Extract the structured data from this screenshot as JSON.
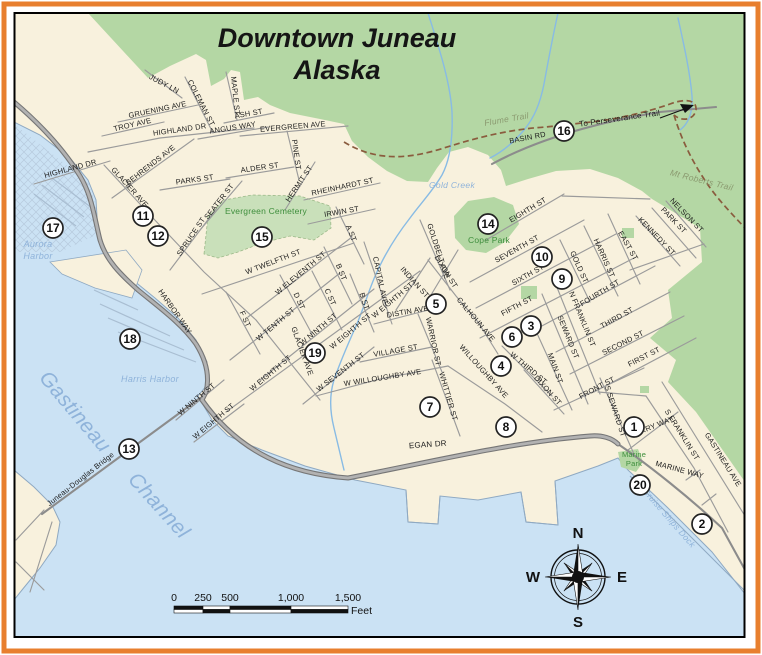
{
  "title": {
    "line1": "Downtown Juneau",
    "line2": "Alaska"
  },
  "colors": {
    "frame_orange": "#e87f2e",
    "map_border": "#000000",
    "land": "#f8f1dd",
    "forest": "#b4d7a4",
    "cemetery": "#c9e0ba",
    "water": "#cbe2f4",
    "shore": "#8fa9c2",
    "dock": "#a9bed2",
    "creek": "#88bbe4",
    "road_thin": "#9b9b9b",
    "road_medium": "#8c8c8c",
    "road_thick_casing": "#767676",
    "road_thick_core": "#b2b2b2",
    "trail": "#8a5c3e",
    "street_text": "#1c1c1c",
    "water_text": "#8fb3da",
    "park_text": "#3e8e3c",
    "trail_text": "#8b9a70",
    "title_text": "#151515"
  },
  "geometry": {
    "map_rect": {
      "x": 14.5,
      "y": 13,
      "w": 730,
      "h": 624
    },
    "orange_rect": {
      "x": 4,
      "y": 4,
      "w": 754,
      "h": 647,
      "sw": 5
    },
    "areas": [
      {
        "name": "forest-area",
        "d": "M88,13 L148,78 L170,66 L196,54 L206,60 L211,86 L224,79 L231,70 L240,72 L244,100 L258,97 L270,105 L290,113 L320,119 L344,124 L352,141 L368,157 L387,171 L407,181 L428,182 L437,168 L449,152 L468,147 L488,155 L501,170 L506,186 L528,179 L556,171 L590,169 L618,178 L642,191 L652,199 L700,228 L702,262 L668,290 L672,318 L650,338 L676,360 L668,382 L696,412 L745,482 L745,13 Z",
        "fill": "forest"
      },
      {
        "name": "evergreen-cemetery-area",
        "d": "M204,254 L208,216 L224,200 L252,195 L300,196 L330,206 L331,228 L314,240 L290,236 L262,243 L238,252 L218,258 Z",
        "fill": "cemetery",
        "stroke": "#9cb989",
        "sw": 0.8,
        "dash": "3,2"
      },
      {
        "name": "water-area",
        "d": "M14,122 L40,135 L70,158 L88,180 L96,200 L98,232 L108,256 L128,276 L155,298 L178,318 L196,340 L207,362 L207,385 L198,396 L212,420 L228,436 L262,450 L305,466 L355,480 L406,490 L408,522 L438,524 L440,496 L478,500 L521,492 L526,522 L558,525 L555,481 L598,466 L618,458 L628,470 L668,508 L712,552 L745,594 L745,637 L14,637 Z",
        "fill": "water"
      },
      {
        "name": "tidal-flat-hatch",
        "d": "M14,124 L88,182 L96,206 L98,234 L60,252 L14,252 Z",
        "fill": "url(#hatch)"
      },
      {
        "name": "shoreline",
        "d": "M14,122 L40,135 L70,158 L88,180 L96,200 L98,232 L108,256 L128,276 L155,298 L178,318 L196,340 L207,362 L207,385 L198,396 L212,420 L228,436 L262,450 L305,466 L355,480 L406,490 L408,522 L438,524 L440,496 L478,500 L521,492 L526,522 L558,525 L555,481 L598,466 L618,458 L628,470 L668,508 L712,552 L745,594",
        "fill": "none",
        "stroke": "shore",
        "sw": 1
      },
      {
        "name": "douglas-island-land",
        "d": "M14,470 L34,487 L52,505 L60,522 L56,545 L40,568 L22,590 L14,600 Z",
        "fill": "land",
        "stroke": "shore",
        "sw": 1
      },
      {
        "name": "harbor-peninsula",
        "d": "M50,262 L126,250 L142,270 L132,298 L95,288 L62,274 Z",
        "fill": "land",
        "stroke": "shore",
        "sw": 0.8
      },
      {
        "name": "cope-park-area",
        "d": "M454,216 L468,201 L494,197 L513,205 L519,224 L505,242 L486,253 L466,250 L455,238 Z",
        "fill": "forest"
      },
      {
        "name": "marine-park-area",
        "d": "M618,452 L638,449 L643,462 L636,472 L621,467 Z",
        "fill": "forest"
      },
      {
        "name": "small-park-1",
        "d": "M521,286 L537,286 L537,299 L521,299 Z",
        "fill": "forest"
      },
      {
        "name": "small-park-2",
        "d": "M622,228 L634,228 L634,238 L622,238 Z",
        "fill": "forest"
      },
      {
        "name": "small-park-3",
        "d": "M640,386 L649,386 L649,393 L640,393 Z",
        "fill": "forest"
      }
    ],
    "docks": [
      "M34,194 L76,226",
      "M42,185 L84,217",
      "M52,178 L92,208",
      "M100,304 L170,336",
      "M108,318 L184,350",
      "M118,332 L196,362",
      "M94,290 L138,310"
    ],
    "piers": [
      "M406,490 L408,522 L438,524 L440,496",
      "M521,492 L526,522 L558,525 L555,481",
      "M630,476 L744,590"
    ],
    "creeks": [
      "M428,13 C438,45 450,80 452,112 C453,140 450,160 442,175 C432,192 420,204 410,218 C396,236 384,256 376,274 C368,292 364,308 356,326 C348,344 340,362 334,380 C329,396 330,412 334,428 L344,470",
      "M558,13 C552,40 548,62 544,84 C540,104 534,118 524,130 C514,142 502,152 490,158",
      "M678,18 C684,45 690,72 692,96 C693,114 688,124 680,130"
    ],
    "roads_thin": [
      "M145,70 L182,98",
      "M185,77 L213,133",
      "M226,72 L237,120",
      "M224,123 L274,113",
      "M118,122 L198,105",
      "M102,136 L164,122",
      "M88,152 L160,138 L254,128",
      "M198,139 L268,127",
      "M240,136 L348,126",
      "M287,131 L299,180",
      "M226,178 L294,167",
      "M285,210 L315,162",
      "M304,200 L380,183",
      "M308,224 L375,209",
      "M112,198 L194,139",
      "M34,184 L110,161",
      "M104,165 L152,217 L204,272 L256,320",
      "M160,190 L230,179",
      "M200,230 L242,181",
      "M170,270 L216,209",
      "M202,294 L354,243",
      "M248,317 L352,237",
      "M230,360 L340,273",
      "M260,380 L374,289",
      "M226,412 L420,271",
      "M303,404 L374,347",
      "M336,207 L364,264",
      "M324,247 L352,304",
      "M312,271 L342,330",
      "M280,275 L312,334",
      "M226,292 L260,354",
      "M256,320 L320,400",
      "M364,242 L392,324",
      "M350,274 L374,332",
      "M396,310 L430,258",
      "M420,220 L450,290",
      "M428,300 L458,250",
      "M374,324 L444,306",
      "M360,362 L432,347",
      "M418,314 L442,372",
      "M432,360 L460,436",
      "M316,396 L380,379 L448,366",
      "M448,366 L505,404 L542,432",
      "M176,420 L224,380",
      "M194,442 L244,404",
      "M486,240 L564,194",
      "M562,196 L650,199",
      "M470,282 L584,220",
      "M476,308 L616,234",
      "M480,338 L634,258",
      "M538,328 L655,266",
      "M556,352 L670,292",
      "M570,374 L684,316",
      "M594,392 L696,338",
      "M554,410 L644,368",
      "M560,240 L590,302",
      "M584,226 L618,296",
      "M608,214 L640,284",
      "M636,216 L680,266",
      "M652,208 L696,258",
      "M666,201 L706,247",
      "M630,270 L704,244",
      "M554,280 L600,394",
      "M542,294 L588,404",
      "M530,318 L572,410",
      "M502,346 L552,396",
      "M524,370 L564,414",
      "M428,260 L456,296 L478,322 L498,354",
      "M628,450 L678,412",
      "M600,378 L634,454",
      "M646,396 L694,468 L728,532",
      "M662,382 L745,516",
      "M700,470 L686,480",
      "M716,494 L702,505",
      "M598,392 L646,396",
      "M44,510 L16,540",
      "M52,522 L30,592",
      "M16,562 L44,590"
    ],
    "roads_medium": [
      "M492,164 C540,138 600,122 660,112 L716,107",
      "M618,444 C650,466 690,498 722,528 L744,568",
      "M42,514 L200,398"
    ],
    "roads_thick": [
      "M14,102 C40,124 64,150 80,176 C92,196 94,216 100,240 C106,260 120,274 138,290 C160,308 182,324 196,344 C206,360 210,376 206,392 L202,400 C240,454 292,474 348,478 C430,462 512,442 590,436 C602,435 612,438 618,444"
    ],
    "trails": [
      "M344,142 C378,163 412,158 444,148 C478,137 512,129 546,127 L600,121 C632,116 656,109 670,104 C686,98 697,100 696,110 C694,120 682,122 674,115",
      "M674,115 C682,142 694,164 706,182 C718,200 734,216 745,228"
    ],
    "arrow": {
      "line": "M660,118 L690,107",
      "head": "694,105 680,104 685,113"
    }
  },
  "label_groups": [
    {
      "name": "street-labels",
      "fill_key": "street_text",
      "italic": false,
      "weight": 400,
      "size": 7.5,
      "ls": 0.2,
      "items": [
        {
          "t": "JUDY LN",
          "x": 163,
          "y": 86,
          "r": 28
        },
        {
          "t": "COLEMAN ST",
          "x": 199,
          "y": 104,
          "r": 63
        },
        {
          "t": "MAPLE ST",
          "x": 233,
          "y": 96,
          "r": 84
        },
        {
          "t": "ASH ST",
          "x": 249,
          "y": 116,
          "r": -10
        },
        {
          "t": "GRUENING AVE",
          "x": 158,
          "y": 112,
          "r": -12
        },
        {
          "t": "TROY AVE",
          "x": 133,
          "y": 127,
          "r": -13
        },
        {
          "t": "HIGHLAND DR",
          "x": 180,
          "y": 132,
          "r": -8
        },
        {
          "t": "ANGUS WAY",
          "x": 233,
          "y": 130,
          "r": -9
        },
        {
          "t": "EVERGREEN AVE",
          "x": 293,
          "y": 129,
          "r": -5
        },
        {
          "t": "PINE ST",
          "x": 294,
          "y": 155,
          "r": 82
        },
        {
          "t": "ALDER ST",
          "x": 260,
          "y": 170,
          "r": -8
        },
        {
          "t": "HERMIT ST",
          "x": 301,
          "y": 185,
          "r": -56
        },
        {
          "t": "RHEINHARDT ST",
          "x": 343,
          "y": 189,
          "r": -12
        },
        {
          "t": "IRWIN ST",
          "x": 342,
          "y": 214,
          "r": -10
        },
        {
          "t": "BEHRENDS AVE",
          "x": 152,
          "y": 167,
          "r": -38
        },
        {
          "t": "HIGHLAND DR",
          "x": 71,
          "y": 171,
          "r": -15
        },
        {
          "t": "GLACIER AVE",
          "x": 128,
          "y": 189,
          "r": 48
        },
        {
          "t": "PARKS ST",
          "x": 195,
          "y": 182,
          "r": -8
        },
        {
          "t": "SEATER ST",
          "x": 221,
          "y": 203,
          "r": -52
        },
        {
          "t": "SPRUCE ST",
          "x": 193,
          "y": 238,
          "r": -56
        },
        {
          "t": "HARBOR WAY",
          "x": 173,
          "y": 313,
          "r": 55
        },
        {
          "t": "W TWELFTH ST",
          "x": 274,
          "y": 264,
          "r": -21
        },
        {
          "t": "W ELEVENTH ST",
          "x": 302,
          "y": 275,
          "r": -40
        },
        {
          "t": "W TENTH ST",
          "x": 277,
          "y": 326,
          "r": -40
        },
        {
          "t": "W NINTH ST",
          "x": 320,
          "y": 331,
          "r": -40
        },
        {
          "t": "W EIGHTH ST",
          "x": 272,
          "y": 375,
          "r": -40
        },
        {
          "t": "W EIGHTH ST",
          "x": 352,
          "y": 333,
          "r": -40
        },
        {
          "t": "W EIGHTH ST",
          "x": 394,
          "y": 302,
          "r": -40
        },
        {
          "t": "W SEVENTH ST",
          "x": 342,
          "y": 374,
          "r": -38
        },
        {
          "t": "A ST",
          "x": 349,
          "y": 234,
          "r": 68
        },
        {
          "t": "B ST",
          "x": 339,
          "y": 273,
          "r": 68
        },
        {
          "t": "C ST",
          "x": 328,
          "y": 298,
          "r": 66
        },
        {
          "t": "D ST",
          "x": 297,
          "y": 302,
          "r": 66
        },
        {
          "t": "F ST",
          "x": 243,
          "y": 320,
          "r": 66
        },
        {
          "t": "GLACIER AVE",
          "x": 300,
          "y": 352,
          "r": 70
        },
        {
          "t": "CAPITAL AVE",
          "x": 378,
          "y": 281,
          "r": 78
        },
        {
          "t": "B ST",
          "x": 362,
          "y": 302,
          "r": 72
        },
        {
          "t": "INDIAN ST",
          "x": 413,
          "y": 284,
          "r": 48
        },
        {
          "t": "GOLDBELT AVE",
          "x": 436,
          "y": 252,
          "r": 72
        },
        {
          "t": "DIXON ST",
          "x": 444,
          "y": 273,
          "r": 58
        },
        {
          "t": "DISTIN AVE",
          "x": 408,
          "y": 314,
          "r": -10
        },
        {
          "t": "VILLAGE ST",
          "x": 396,
          "y": 353,
          "r": -10
        },
        {
          "t": "WARRIOR ST",
          "x": 431,
          "y": 342,
          "r": 78
        },
        {
          "t": "WHITTIER ST",
          "x": 446,
          "y": 397,
          "r": 74
        },
        {
          "t": "W WILLOUGHBY AVE",
          "x": 383,
          "y": 380,
          "r": -9
        },
        {
          "t": "WILLOUGHBY AVE",
          "x": 482,
          "y": 373,
          "r": 48
        },
        {
          "t": "W NINTH ST",
          "x": 198,
          "y": 401,
          "r": -40
        },
        {
          "t": "W EIGHTH ST",
          "x": 215,
          "y": 423,
          "r": -40
        },
        {
          "t": "EGAN DR",
          "x": 428,
          "y": 447,
          "r": -4,
          "s": 8
        },
        {
          "t": "EIGHTH ST",
          "x": 529,
          "y": 212,
          "r": -31
        },
        {
          "t": "SEVENTH ST",
          "x": 518,
          "y": 251,
          "r": -29
        },
        {
          "t": "SIXTH ST",
          "x": 529,
          "y": 277,
          "r": -29
        },
        {
          "t": "FIFTH ST",
          "x": 518,
          "y": 308,
          "r": -28
        },
        {
          "t": "FOURTH ST",
          "x": 601,
          "y": 295,
          "r": -31
        },
        {
          "t": "THIRD ST",
          "x": 618,
          "y": 320,
          "r": -29
        },
        {
          "t": "SECOND ST",
          "x": 624,
          "y": 345,
          "r": -27
        },
        {
          "t": "FIRST ST",
          "x": 645,
          "y": 359,
          "r": -27
        },
        {
          "t": "FRONT ST",
          "x": 598,
          "y": 390,
          "r": -28
        },
        {
          "t": "GOLD ST",
          "x": 577,
          "y": 268,
          "r": 66
        },
        {
          "t": "HARRIS ST",
          "x": 602,
          "y": 259,
          "r": 66
        },
        {
          "t": "EAST ST",
          "x": 626,
          "y": 247,
          "r": 60
        },
        {
          "t": "KENNEDY ST",
          "x": 655,
          "y": 238,
          "r": 46
        },
        {
          "t": "PARK ST",
          "x": 672,
          "y": 222,
          "r": 46
        },
        {
          "t": "NELSON ST",
          "x": 685,
          "y": 217,
          "r": 46
        },
        {
          "t": "N FRANKLIN ST",
          "x": 580,
          "y": 320,
          "r": 68
        },
        {
          "t": "SEWARD ST",
          "x": 566,
          "y": 338,
          "r": 68
        },
        {
          "t": "MAIN ST",
          "x": 553,
          "y": 369,
          "r": 70
        },
        {
          "t": "W THIRD ST",
          "x": 527,
          "y": 370,
          "r": 40
        },
        {
          "t": "DIXON ST",
          "x": 546,
          "y": 392,
          "r": 48
        },
        {
          "t": "CALHOUN AVE",
          "x": 474,
          "y": 321,
          "r": 50
        },
        {
          "t": "FERRY WAY",
          "x": 653,
          "y": 429,
          "r": -22
        },
        {
          "t": "S SEWARD ST",
          "x": 613,
          "y": 412,
          "r": 72
        },
        {
          "t": "S FRANKLIN ST",
          "x": 680,
          "y": 436,
          "r": 58
        },
        {
          "t": "GASTINEAU AVE",
          "x": 721,
          "y": 461,
          "r": 58
        },
        {
          "t": "MARINE WAY",
          "x": 679,
          "y": 472,
          "r": 15
        },
        {
          "t": "BASIN RD",
          "x": 528,
          "y": 140,
          "r": -11
        },
        {
          "t": "Juneau-Douglas Bridge",
          "x": 82,
          "y": 481,
          "r": -38
        },
        {
          "t": "To Perseverance Trail",
          "x": 620,
          "y": 121,
          "r": -8,
          "s": 8
        }
      ]
    },
    {
      "name": "water-labels",
      "fill_key": "water_text",
      "italic": true,
      "weight": 400,
      "size": 9,
      "ls": 0.3,
      "items": [
        {
          "t": "Aurora",
          "x": 38,
          "y": 247
        },
        {
          "t": "Harbor",
          "x": 38,
          "y": 259
        },
        {
          "t": "Harris Harbor",
          "x": 150,
          "y": 382
        },
        {
          "t": "Gastineau",
          "x": 70,
          "y": 416,
          "r": 50,
          "s": 21
        },
        {
          "t": "Channel",
          "x": 154,
          "y": 510,
          "r": 48,
          "s": 21
        },
        {
          "t": "Gold Creek",
          "x": 452,
          "y": 188,
          "s": 8.5
        },
        {
          "t": "Cruise Ships Dock",
          "x": 667,
          "y": 520,
          "r": 49,
          "s": 8.5
        }
      ]
    },
    {
      "name": "park-labels",
      "fill_key": "park_text",
      "italic": false,
      "weight": 400,
      "size": 8.5,
      "ls": 0.2,
      "items": [
        {
          "t": "Evergreen Cemetery",
          "x": 266,
          "y": 214
        },
        {
          "t": "Cope Park",
          "x": 489,
          "y": 243
        },
        {
          "t": "Marine",
          "x": 634,
          "y": 457,
          "s": 7.5
        },
        {
          "t": "Park",
          "x": 634,
          "y": 466,
          "s": 7.5
        }
      ]
    },
    {
      "name": "trail-labels",
      "fill_key": "trail_text",
      "italic": true,
      "weight": 400,
      "size": 8.5,
      "ls": 0.3,
      "items": [
        {
          "t": "Flume Trail",
          "x": 507,
          "y": 122,
          "r": -10
        },
        {
          "t": "Mt Roberts Trail",
          "x": 701,
          "y": 183,
          "r": 14
        }
      ]
    }
  ],
  "markers": [
    {
      "n": "1",
      "x": 634,
      "y": 427
    },
    {
      "n": "2",
      "x": 702,
      "y": 524
    },
    {
      "n": "3",
      "x": 531,
      "y": 326
    },
    {
      "n": "4",
      "x": 501,
      "y": 366
    },
    {
      "n": "5",
      "x": 436,
      "y": 304
    },
    {
      "n": "6",
      "x": 512,
      "y": 337
    },
    {
      "n": "7",
      "x": 430,
      "y": 407
    },
    {
      "n": "8",
      "x": 506,
      "y": 427
    },
    {
      "n": "9",
      "x": 562,
      "y": 279
    },
    {
      "n": "10",
      "x": 542,
      "y": 257
    },
    {
      "n": "11",
      "x": 143,
      "y": 216
    },
    {
      "n": "12",
      "x": 158,
      "y": 236
    },
    {
      "n": "13",
      "x": 129,
      "y": 449
    },
    {
      "n": "14",
      "x": 488,
      "y": 224
    },
    {
      "n": "15",
      "x": 262,
      "y": 237
    },
    {
      "n": "16",
      "x": 564,
      "y": 131
    },
    {
      "n": "17",
      "x": 53,
      "y": 228
    },
    {
      "n": "18",
      "x": 130,
      "y": 339
    },
    {
      "n": "19",
      "x": 315,
      "y": 353
    },
    {
      "n": "20",
      "x": 640,
      "y": 485
    }
  ],
  "compass": {
    "cx": 578,
    "cy": 577,
    "n": "N",
    "e": "E",
    "s": "S",
    "w": "W"
  },
  "scale_bar": {
    "x": 174,
    "y": 606,
    "h": 7,
    "cells": [
      29,
      27,
      61,
      57
    ],
    "labels": [
      {
        "t": "0",
        "x": 174
      },
      {
        "t": "250",
        "x": 203
      },
      {
        "t": "500",
        "x": 230
      },
      {
        "t": "1,000",
        "x": 291
      },
      {
        "t": "1,500",
        "x": 348
      }
    ],
    "unit": "Feet"
  }
}
